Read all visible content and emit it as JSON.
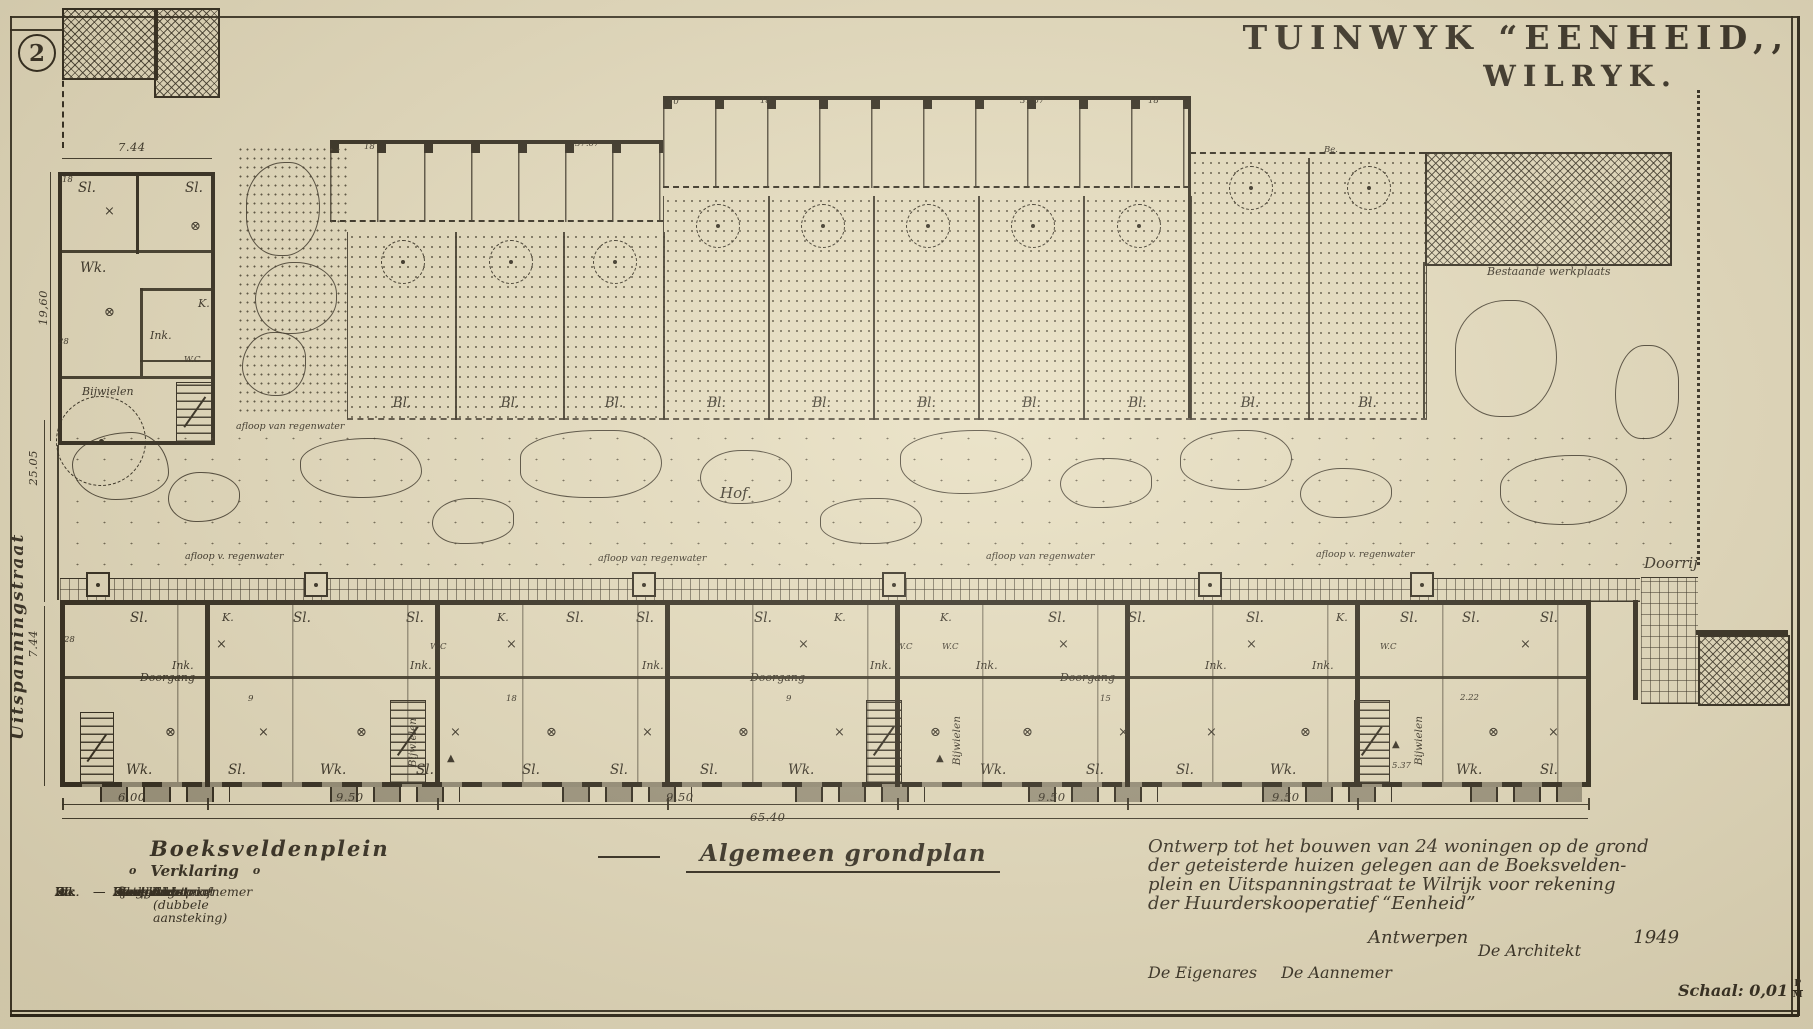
{
  "sheet": {
    "number": "2",
    "title_line1": "TUINWYK “EENHEID,,",
    "title_line2": "WILRYK.",
    "plan_title": "Algemeen grondplan",
    "scale_label": "Schaal: 0,01",
    "scale_num": "P",
    "scale_den": "M"
  },
  "streets": {
    "left": "Uitspanningstraat",
    "bottom": "Boeksveldenplein"
  },
  "legend": {
    "bullet": "o",
    "heading": "Verklaring",
    "items": [
      {
        "abbr": "Ink.",
        "term": "Inkom"
      },
      {
        "abbr": "Wk.",
        "term": "Woonkamer"
      },
      {
        "abbr": "Sl.",
        "term": "Slaapkamer"
      },
      {
        "abbr": "K.",
        "term": "Keuken"
      },
      {
        "abbr": "St.",
        "term": "Stortbad"
      },
      {
        "abbr": "Wc",
        "term": "Watercloset"
      },
      {
        "abbr": "Do.",
        "term": "Doorgang"
      },
      {
        "abbr": "Bl.",
        "term": "Bleekveld"
      },
      {
        "abbr": "Be.",
        "term": "Bergplaats"
      }
    ],
    "symbols": [
      {
        "glyph": "×",
        "label": "Lichtpunt"
      },
      {
        "glyph": "δ",
        "label": "Aansteker"
      },
      {
        "glyph": "ɣ",
        "label": "Stroomafnemer"
      },
      {
        "glyph": "⊗",
        "label": "Lichtpunt (dubbele aansteking)"
      }
    ]
  },
  "note": {
    "lines": [
      "Ontwerp tot het bouwen van 24 woningen op de grond",
      "der geteisterde huizen gelegen aan de Boeksvelden-",
      "plein en Uitspanningstraat te Wilrijk voor rekening",
      "der Huurderskooperatief “Eenheid”"
    ],
    "city": "Antwerpen",
    "year": "1949",
    "architect": "De Architekt",
    "owner": "De Eigenares",
    "contractor": "De Aannemer"
  },
  "plan_labels": [
    {
      "t": "7.44",
      "x": 118,
      "y": 142,
      "c": "dim"
    },
    {
      "t": "19,60",
      "x": 38,
      "y": 290,
      "c": "dim vert"
    },
    {
      "t": "25.05",
      "x": 28,
      "y": 450,
      "c": "dim vert"
    },
    {
      "t": "7.44",
      "x": 28,
      "y": 630,
      "c": "dim vert"
    },
    {
      "t": "Sl.",
      "x": 78,
      "y": 182,
      "c": "rm"
    },
    {
      "t": "Sl.",
      "x": 185,
      "y": 182,
      "c": "rm"
    },
    {
      "t": "×",
      "x": 104,
      "y": 205,
      "c": "sym"
    },
    {
      "t": "⊗",
      "x": 190,
      "y": 220,
      "c": "sym"
    },
    {
      "t": "Wk.",
      "x": 80,
      "y": 262,
      "c": "rm"
    },
    {
      "t": "⊗",
      "x": 104,
      "y": 306,
      "c": "sym"
    },
    {
      "t": "K.",
      "x": 198,
      "y": 298,
      "c": "rm sm"
    },
    {
      "t": "Ink.",
      "x": 150,
      "y": 330,
      "c": "rm sm"
    },
    {
      "t": "W.C",
      "x": 184,
      "y": 356,
      "c": "tiny"
    },
    {
      "t": "Bijwielen",
      "x": 82,
      "y": 386,
      "c": "scr xs"
    },
    {
      "t": "18",
      "x": 62,
      "y": 176,
      "c": "tiny"
    },
    {
      "t": "28",
      "x": 58,
      "y": 338,
      "c": "tiny"
    },
    {
      "t": "18",
      "x": 364,
      "y": 143,
      "c": "tiny"
    },
    {
      "t": "37.67",
      "x": 575,
      "y": 140,
      "c": "tiny"
    },
    {
      "t": "10",
      "x": 668,
      "y": 98,
      "c": "tiny"
    },
    {
      "t": "18",
      "x": 760,
      "y": 97,
      "c": "tiny"
    },
    {
      "t": "37.67",
      "x": 1020,
      "y": 97,
      "c": "tiny"
    },
    {
      "t": "18",
      "x": 1148,
      "y": 97,
      "c": "tiny"
    },
    {
      "t": "Be.",
      "x": 1324,
      "y": 146,
      "c": "tiny"
    },
    {
      "t": "Bestaande werkplaats",
      "x": 1487,
      "y": 266,
      "c": "scr xs"
    },
    {
      "t": "afloop van regenwater",
      "x": 236,
      "y": 422,
      "c": "scr xxs"
    },
    {
      "t": "Hof.",
      "x": 720,
      "y": 486,
      "c": "scr"
    },
    {
      "t": "afloop v. regenwater",
      "x": 185,
      "y": 552,
      "c": "scr xxs"
    },
    {
      "t": "afloop van regenwater",
      "x": 598,
      "y": 554,
      "c": "scr xxs"
    },
    {
      "t": "afloop van regenwater",
      "x": 986,
      "y": 552,
      "c": "scr xxs"
    },
    {
      "t": "afloop v. regenwater",
      "x": 1316,
      "y": 550,
      "c": "scr xxs"
    },
    {
      "t": "Doorrij",
      "x": 1644,
      "y": 556,
      "c": "scr"
    },
    {
      "t": "Wk.",
      "x": 126,
      "y": 764,
      "c": "rm"
    },
    {
      "t": "Sl.",
      "x": 228,
      "y": 764,
      "c": "rm"
    },
    {
      "t": "Wk.",
      "x": 320,
      "y": 764,
      "c": "rm"
    },
    {
      "t": "Sl.",
      "x": 416,
      "y": 764,
      "c": "rm"
    },
    {
      "t": "Sl.",
      "x": 522,
      "y": 764,
      "c": "rm"
    },
    {
      "t": "Sl.",
      "x": 610,
      "y": 764,
      "c": "rm"
    },
    {
      "t": "Sl.",
      "x": 700,
      "y": 764,
      "c": "rm"
    },
    {
      "t": "Wk.",
      "x": 788,
      "y": 764,
      "c": "rm"
    },
    {
      "t": "Wk.",
      "x": 980,
      "y": 764,
      "c": "rm"
    },
    {
      "t": "Sl.",
      "x": 1086,
      "y": 764,
      "c": "rm"
    },
    {
      "t": "Sl.",
      "x": 1176,
      "y": 764,
      "c": "rm"
    },
    {
      "t": "Wk.",
      "x": 1270,
      "y": 764,
      "c": "rm"
    },
    {
      "t": "Wk.",
      "x": 1456,
      "y": 764,
      "c": "rm"
    },
    {
      "t": "Sl.",
      "x": 1540,
      "y": 764,
      "c": "rm"
    },
    {
      "t": "Sl.",
      "x": 130,
      "y": 612,
      "c": "rm"
    },
    {
      "t": "K.",
      "x": 222,
      "y": 612,
      "c": "rm sm"
    },
    {
      "t": "Sl.",
      "x": 293,
      "y": 612,
      "c": "rm"
    },
    {
      "t": "Sl.",
      "x": 406,
      "y": 612,
      "c": "rm"
    },
    {
      "t": "K.",
      "x": 497,
      "y": 612,
      "c": "rm sm"
    },
    {
      "t": "Sl.",
      "x": 566,
      "y": 612,
      "c": "rm"
    },
    {
      "t": "Sl.",
      "x": 636,
      "y": 612,
      "c": "rm"
    },
    {
      "t": "Sl.",
      "x": 754,
      "y": 612,
      "c": "rm"
    },
    {
      "t": "K.",
      "x": 834,
      "y": 612,
      "c": "rm sm"
    },
    {
      "t": "K.",
      "x": 940,
      "y": 612,
      "c": "rm sm"
    },
    {
      "t": "Sl.",
      "x": 1048,
      "y": 612,
      "c": "rm"
    },
    {
      "t": "Sl.",
      "x": 1128,
      "y": 612,
      "c": "rm"
    },
    {
      "t": "Sl.",
      "x": 1246,
      "y": 612,
      "c": "rm"
    },
    {
      "t": "K.",
      "x": 1336,
      "y": 612,
      "c": "rm sm"
    },
    {
      "t": "Sl.",
      "x": 1400,
      "y": 612,
      "c": "rm"
    },
    {
      "t": "Sl.",
      "x": 1462,
      "y": 612,
      "c": "rm"
    },
    {
      "t": "Sl.",
      "x": 1540,
      "y": 612,
      "c": "rm"
    },
    {
      "t": "Ink.",
      "x": 172,
      "y": 660,
      "c": "rm sm"
    },
    {
      "t": "Ink.",
      "x": 410,
      "y": 660,
      "c": "rm sm"
    },
    {
      "t": "Ink.",
      "x": 642,
      "y": 660,
      "c": "rm sm"
    },
    {
      "t": "Ink.",
      "x": 870,
      "y": 660,
      "c": "rm sm"
    },
    {
      "t": "Ink.",
      "x": 976,
      "y": 660,
      "c": "rm sm"
    },
    {
      "t": "Ink.",
      "x": 1205,
      "y": 660,
      "c": "rm sm"
    },
    {
      "t": "Ink.",
      "x": 1312,
      "y": 660,
      "c": "rm sm"
    },
    {
      "t": "W.C",
      "x": 430,
      "y": 643,
      "c": "tiny"
    },
    {
      "t": "W.C",
      "x": 896,
      "y": 643,
      "c": "tiny"
    },
    {
      "t": "W.C",
      "x": 942,
      "y": 643,
      "c": "tiny"
    },
    {
      "t": "W.C",
      "x": 1380,
      "y": 643,
      "c": "tiny"
    },
    {
      "t": "Doorgang",
      "x": 140,
      "y": 672,
      "c": "scr xs"
    },
    {
      "t": "Doorgang",
      "x": 750,
      "y": 672,
      "c": "scr xs"
    },
    {
      "t": "Doorgang",
      "x": 1060,
      "y": 672,
      "c": "scr xs"
    },
    {
      "t": "Bijwielen",
      "x": 408,
      "y": 718,
      "c": "vscr"
    },
    {
      "t": "Bijwielen",
      "x": 952,
      "y": 716,
      "c": "vscr"
    },
    {
      "t": "Bijwielen",
      "x": 1414,
      "y": 716,
      "c": "vscr"
    },
    {
      "t": "5.37",
      "x": 1392,
      "y": 762,
      "c": "tiny"
    },
    {
      "t": "2.22",
      "x": 1460,
      "y": 694,
      "c": "tiny"
    },
    {
      "t": "⊗",
      "x": 165,
      "y": 726,
      "c": "sym"
    },
    {
      "t": "×",
      "x": 258,
      "y": 726,
      "c": "sym"
    },
    {
      "t": "⊗",
      "x": 356,
      "y": 726,
      "c": "sym"
    },
    {
      "t": "×",
      "x": 450,
      "y": 726,
      "c": "sym"
    },
    {
      "t": "⊗",
      "x": 546,
      "y": 726,
      "c": "sym"
    },
    {
      "t": "×",
      "x": 642,
      "y": 726,
      "c": "sym"
    },
    {
      "t": "⊗",
      "x": 738,
      "y": 726,
      "c": "sym"
    },
    {
      "t": "×",
      "x": 834,
      "y": 726,
      "c": "sym"
    },
    {
      "t": "⊗",
      "x": 930,
      "y": 726,
      "c": "sym"
    },
    {
      "t": "⊗",
      "x": 1022,
      "y": 726,
      "c": "sym"
    },
    {
      "t": "×",
      "x": 1118,
      "y": 726,
      "c": "sym"
    },
    {
      "t": "×",
      "x": 1206,
      "y": 726,
      "c": "sym"
    },
    {
      "t": "⊗",
      "x": 1300,
      "y": 726,
      "c": "sym"
    },
    {
      "t": "⊗",
      "x": 1488,
      "y": 726,
      "c": "sym"
    },
    {
      "t": "×",
      "x": 1548,
      "y": 726,
      "c": "sym"
    },
    {
      "t": "×",
      "x": 216,
      "y": 638,
      "c": "sym"
    },
    {
      "t": "×",
      "x": 506,
      "y": 638,
      "c": "sym"
    },
    {
      "t": "×",
      "x": 798,
      "y": 638,
      "c": "sym"
    },
    {
      "t": "×",
      "x": 1058,
      "y": 638,
      "c": "sym"
    },
    {
      "t": "×",
      "x": 1246,
      "y": 638,
      "c": "sym"
    },
    {
      "t": "×",
      "x": 1520,
      "y": 638,
      "c": "sym"
    },
    {
      "t": "▲",
      "x": 447,
      "y": 754,
      "c": "arr"
    },
    {
      "t": "▲",
      "x": 936,
      "y": 754,
      "c": "arr"
    },
    {
      "t": "▲",
      "x": 1392,
      "y": 740,
      "c": "arr"
    },
    {
      "t": "9",
      "x": 248,
      "y": 695,
      "c": "tiny"
    },
    {
      "t": "18",
      "x": 506,
      "y": 695,
      "c": "tiny"
    },
    {
      "t": "9",
      "x": 786,
      "y": 695,
      "c": "tiny"
    },
    {
      "t": "15",
      "x": 1100,
      "y": 695,
      "c": "tiny"
    },
    {
      "t": "28",
      "x": 64,
      "y": 636,
      "c": "tiny"
    },
    {
      "t": "6.00",
      "x": 118,
      "y": 792,
      "c": "dim"
    },
    {
      "t": "9.50",
      "x": 336,
      "y": 792,
      "c": "dim"
    },
    {
      "t": "9.50",
      "x": 666,
      "y": 792,
      "c": "dim"
    },
    {
      "t": "9.50",
      "x": 1038,
      "y": 792,
      "c": "dim"
    },
    {
      "t": "9.50",
      "x": 1272,
      "y": 792,
      "c": "dim"
    },
    {
      "t": "65.40",
      "x": 750,
      "y": 812,
      "c": "dim"
    }
  ],
  "plots": [
    {
      "x": 347,
      "y": 232,
      "w": 108,
      "h": 186,
      "label": "Bl."
    },
    {
      "x": 455,
      "y": 232,
      "w": 108,
      "h": 186,
      "label": "Bl."
    },
    {
      "x": 563,
      "y": 232,
      "w": 100,
      "h": 186,
      "label": "Bl."
    },
    {
      "x": 663,
      "y": 196,
      "w": 105,
      "h": 222,
      "label": "Bl."
    },
    {
      "x": 768,
      "y": 196,
      "w": 105,
      "h": 222,
      "label": "Bl."
    },
    {
      "x": 873,
      "y": 196,
      "w": 105,
      "h": 222,
      "label": "Bl."
    },
    {
      "x": 978,
      "y": 196,
      "w": 105,
      "h": 222,
      "label": "Bl."
    },
    {
      "x": 1083,
      "y": 196,
      "w": 107,
      "h": 222,
      "label": "Bl."
    },
    {
      "x": 1190,
      "y": 158,
      "w": 118,
      "h": 260,
      "label": "Bl."
    },
    {
      "x": 1308,
      "y": 158,
      "w": 117,
      "h": 260,
      "label": "Bl."
    }
  ],
  "bays": [
    {
      "x": 62
    },
    {
      "x": 207
    },
    {
      "x": 437
    },
    {
      "x": 667
    },
    {
      "x": 897
    },
    {
      "x": 1127
    },
    {
      "x": 1357
    },
    {
      "x": 1588
    }
  ],
  "stairs": [
    {
      "x": 176,
      "y": 382,
      "w": 36,
      "h": 59
    },
    {
      "x": 80,
      "y": 712,
      "w": 32,
      "h": 70
    },
    {
      "x": 390,
      "y": 700,
      "w": 34,
      "h": 82
    },
    {
      "x": 866,
      "y": 700,
      "w": 34,
      "h": 82
    },
    {
      "x": 1354,
      "y": 700,
      "w": 34,
      "h": 82
    }
  ],
  "basements": [
    {
      "x": 100,
      "y": 787,
      "w": 130
    },
    {
      "x": 330,
      "y": 787,
      "w": 130
    },
    {
      "x": 562,
      "y": 787,
      "w": 130
    },
    {
      "x": 795,
      "y": 787,
      "w": 130
    },
    {
      "x": 1028,
      "y": 787,
      "w": 130
    },
    {
      "x": 1262,
      "y": 787,
      "w": 130
    },
    {
      "x": 1470,
      "y": 787,
      "w": 112
    }
  ],
  "planters": [
    {
      "x": 86,
      "y": 572
    },
    {
      "x": 304,
      "y": 572
    },
    {
      "x": 632,
      "y": 572
    },
    {
      "x": 882,
      "y": 572
    },
    {
      "x": 1198,
      "y": 572
    },
    {
      "x": 1410,
      "y": 572
    }
  ],
  "blobs": [
    {
      "x": 72,
      "y": 432,
      "w": 95,
      "h": 66,
      "r": "62% 38% 55% 45% / 48% 60% 40% 52%"
    },
    {
      "x": 168,
      "y": 472,
      "w": 70,
      "h": 48,
      "r": "45% 55% 60% 40% / 55% 45% 52% 48%"
    },
    {
      "x": 300,
      "y": 438,
      "w": 120,
      "h": 58,
      "r": "58% 42% 50% 50% / 42% 58% 46% 54%"
    },
    {
      "x": 432,
      "y": 498,
      "w": 80,
      "h": 44,
      "r": "50% 50% 62% 38% / 60% 40% 50% 50%"
    },
    {
      "x": 520,
      "y": 430,
      "w": 140,
      "h": 66,
      "r": "62% 38% 48% 52% / 45% 55% 58% 42%"
    },
    {
      "x": 700,
      "y": 450,
      "w": 90,
      "h": 52,
      "r": "48% 52% 58% 42% / 55% 45% 48% 52%"
    },
    {
      "x": 820,
      "y": 498,
      "w": 100,
      "h": 44,
      "r": "55% 45% 50% 50% / 48% 52% 56% 44%"
    },
    {
      "x": 900,
      "y": 430,
      "w": 130,
      "h": 62,
      "r": "60% 40% 52% 48% / 44% 56% 50% 50%"
    },
    {
      "x": 1060,
      "y": 458,
      "w": 90,
      "h": 48,
      "r": "50% 50% 58% 42% / 56% 44% 48% 52%"
    },
    {
      "x": 1180,
      "y": 430,
      "w": 110,
      "h": 58,
      "r": "58% 42% 46% 54% / 50% 50% 56% 44%"
    },
    {
      "x": 1300,
      "y": 468,
      "w": 90,
      "h": 48,
      "r": "46% 54% 58% 42% / 54% 46% 50% 50%"
    },
    {
      "x": 1455,
      "y": 300,
      "w": 100,
      "h": 115,
      "r": "55% 45% 52% 48% / 46% 54% 56% 44%"
    },
    {
      "x": 1500,
      "y": 455,
      "w": 125,
      "h": 68,
      "r": "60% 40% 50% 50% / 48% 52% 54% 46%"
    },
    {
      "x": 1615,
      "y": 345,
      "w": 62,
      "h": 92,
      "r": "50% 50% 56% 44% / 58% 42% 48% 52%"
    },
    {
      "x": 246,
      "y": 162,
      "w": 72,
      "h": 92,
      "r": "56% 44% 52% 48% / 48% 52% 56% 44%"
    },
    {
      "x": 255,
      "y": 262,
      "w": 80,
      "h": 70,
      "r": "48% 52% 58% 42% / 54% 46% 50% 50%"
    },
    {
      "x": 242,
      "y": 332,
      "w": 62,
      "h": 62,
      "r": "52% 48% 46% 54% / 58% 42% 52% 48%"
    }
  ]
}
